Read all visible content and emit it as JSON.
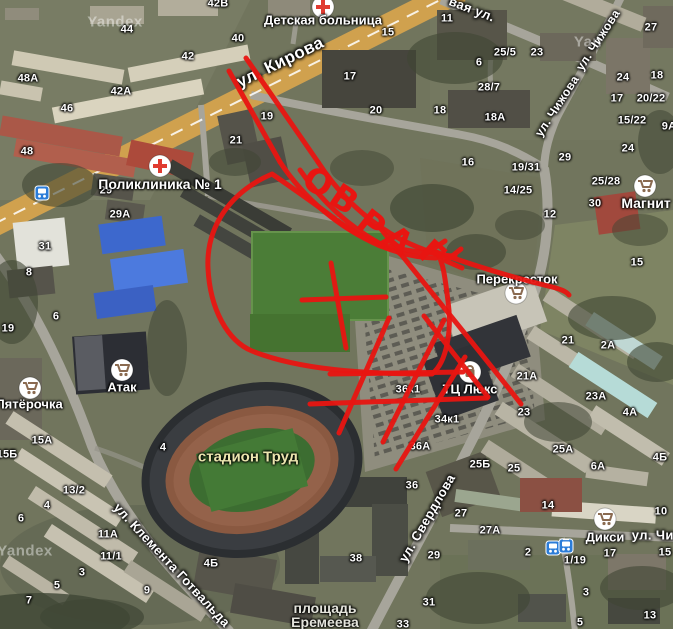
{
  "map": {
    "provider_watermark": "Yandex"
  },
  "watermarks": [
    {
      "text": "Yandex",
      "x": 115,
      "y": 22
    },
    {
      "text": "Yan",
      "x": 588,
      "y": 42
    },
    {
      "text": "Yandex",
      "x": 25,
      "y": 551
    }
  ],
  "streets": [
    {
      "name": "ул. Кирова",
      "x": 280,
      "y": 62,
      "rot": -26,
      "size": 17
    },
    {
      "name": "вая ул.",
      "x": 472,
      "y": 9,
      "rot": 21,
      "size": 13
    },
    {
      "name": "ул. Чижова",
      "x": 598,
      "y": 40,
      "rot": -57,
      "size": 12
    },
    {
      "name": "ул. Чижова",
      "x": 557,
      "y": 106,
      "rot": -57,
      "size": 12
    },
    {
      "name": "ул. Свердлова",
      "x": 427,
      "y": 518,
      "rot": -60,
      "size": 13
    },
    {
      "name": "ул. Клемента Готвальда",
      "x": 172,
      "y": 565,
      "rot": 47,
      "size": 13
    },
    {
      "name": "ул. Чистова",
      "x": 672,
      "y": 535,
      "rot": 0,
      "size": 13
    }
  ],
  "poi": [
    {
      "name": "Детская больница",
      "tx": 323,
      "ty": 20,
      "ix": 323,
      "iy": 7,
      "icon": "cross",
      "size": 13
    },
    {
      "name": "Поликлиника № 1",
      "tx": 160,
      "ty": 184,
      "ix": 160,
      "iy": 166,
      "icon": "cross",
      "size": 14
    },
    {
      "name": "Магнит",
      "tx": 646,
      "ty": 203,
      "ix": 645,
      "iy": 186,
      "icon": "cart",
      "size": 14
    },
    {
      "name": "Перекресток",
      "tx": 517,
      "ty": 279,
      "ix": 516,
      "iy": 293,
      "icon": "cart",
      "size": 13
    },
    {
      "name": "Атак",
      "tx": 122,
      "ty": 387,
      "ix": 122,
      "iy": 370,
      "icon": "cart",
      "size": 13
    },
    {
      "name": "Пятёрочка",
      "tx": 29,
      "ty": 404,
      "ix": 30,
      "iy": 388,
      "icon": "cart",
      "size": 13
    },
    {
      "name": "ТЦ Люкс",
      "tx": 470,
      "ty": 389,
      "ix": 470,
      "iy": 372,
      "icon": "bag",
      "size": 13
    },
    {
      "name": "Дикси",
      "tx": 605,
      "ty": 537,
      "ix": 605,
      "iy": 519,
      "icon": "cart",
      "size": 13
    }
  ],
  "area_labels": [
    {
      "lines": [
        "стадион Труд"
      ],
      "x": 248,
      "y": 457,
      "color": "#ebe5ae",
      "size": 15
    },
    {
      "lines": [
        "площадь",
        "Еремеева"
      ],
      "x": 325,
      "y": 615,
      "color": "#e4e4dc",
      "size": 14
    }
  ],
  "transit_stops": [
    {
      "x": 42,
      "y": 193,
      "type": "bus"
    },
    {
      "x": 553,
      "y": 548,
      "type": "bus"
    },
    {
      "x": 566,
      "y": 546,
      "type": "tram"
    }
  ],
  "building_numbers": [
    {
      "t": "44",
      "x": 127,
      "y": 30
    },
    {
      "t": "42В",
      "x": 218,
      "y": 4
    },
    {
      "t": "42",
      "x": 188,
      "y": 57
    },
    {
      "t": "48А",
      "x": 28,
      "y": 79
    },
    {
      "t": "42А",
      "x": 121,
      "y": 92
    },
    {
      "t": "46",
      "x": 67,
      "y": 109
    },
    {
      "t": "48",
      "x": 27,
      "y": 152
    },
    {
      "t": "40",
      "x": 238,
      "y": 39
    },
    {
      "t": "15",
      "x": 388,
      "y": 33
    },
    {
      "t": "17",
      "x": 350,
      "y": 77
    },
    {
      "t": "20",
      "x": 376,
      "y": 111
    },
    {
      "t": "18",
      "x": 440,
      "y": 111
    },
    {
      "t": "19",
      "x": 267,
      "y": 117
    },
    {
      "t": "21",
      "x": 236,
      "y": 141
    },
    {
      "t": "11",
      "x": 447,
      "y": 19
    },
    {
      "t": "25/5",
      "x": 505,
      "y": 53
    },
    {
      "t": "23",
      "x": 537,
      "y": 53
    },
    {
      "t": "27",
      "x": 651,
      "y": 28
    },
    {
      "t": "6",
      "x": 479,
      "y": 63
    },
    {
      "t": "28/7",
      "x": 489,
      "y": 88
    },
    {
      "t": "18А",
      "x": 495,
      "y": 118
    },
    {
      "t": "24",
      "x": 623,
      "y": 78
    },
    {
      "t": "18",
      "x": 657,
      "y": 76
    },
    {
      "t": "17",
      "x": 617,
      "y": 99
    },
    {
      "t": "20/22",
      "x": 651,
      "y": 99
    },
    {
      "t": "15/22",
      "x": 632,
      "y": 121
    },
    {
      "t": "9А",
      "x": 669,
      "y": 127
    },
    {
      "t": "16",
      "x": 468,
      "y": 163
    },
    {
      "t": "29",
      "x": 565,
      "y": 158
    },
    {
      "t": "19/31",
      "x": 526,
      "y": 168
    },
    {
      "t": "25/28",
      "x": 606,
      "y": 182
    },
    {
      "t": "14/25",
      "x": 518,
      "y": 191
    },
    {
      "t": "30",
      "x": 595,
      "y": 204
    },
    {
      "t": "24",
      "x": 628,
      "y": 149
    },
    {
      "t": "12",
      "x": 550,
      "y": 215
    },
    {
      "t": "15",
      "x": 637,
      "y": 263
    },
    {
      "t": "29",
      "x": 106,
      "y": 191
    },
    {
      "t": "29А",
      "x": 120,
      "y": 215
    },
    {
      "t": "31",
      "x": 45,
      "y": 247
    },
    {
      "t": "8",
      "x": 29,
      "y": 273
    },
    {
      "t": "19",
      "x": 8,
      "y": 329
    },
    {
      "t": "6",
      "x": 56,
      "y": 317
    },
    {
      "t": "15А",
      "x": 42,
      "y": 441
    },
    {
      "t": "15Б",
      "x": 7,
      "y": 455
    },
    {
      "t": "4",
      "x": 163,
      "y": 448
    },
    {
      "t": "36к1",
      "x": 408,
      "y": 390
    },
    {
      "t": "34к1",
      "x": 447,
      "y": 420
    },
    {
      "t": "36А",
      "x": 420,
      "y": 447
    },
    {
      "t": "36",
      "x": 412,
      "y": 486
    },
    {
      "t": "38",
      "x": 356,
      "y": 559
    },
    {
      "t": "21",
      "x": 568,
      "y": 341
    },
    {
      "t": "2А",
      "x": 608,
      "y": 346
    },
    {
      "t": "21А",
      "x": 527,
      "y": 377
    },
    {
      "t": "23",
      "x": 524,
      "y": 413
    },
    {
      "t": "23А",
      "x": 596,
      "y": 397
    },
    {
      "t": "4А",
      "x": 630,
      "y": 413
    },
    {
      "t": "25А",
      "x": 563,
      "y": 450
    },
    {
      "t": "25Б",
      "x": 480,
      "y": 465
    },
    {
      "t": "25",
      "x": 514,
      "y": 469
    },
    {
      "t": "6А",
      "x": 598,
      "y": 467
    },
    {
      "t": "4Б",
      "x": 660,
      "y": 458
    },
    {
      "t": "27",
      "x": 461,
      "y": 514
    },
    {
      "t": "27А",
      "x": 490,
      "y": 531
    },
    {
      "t": "14",
      "x": 548,
      "y": 506
    },
    {
      "t": "10",
      "x": 661,
      "y": 512
    },
    {
      "t": "2",
      "x": 528,
      "y": 553
    },
    {
      "t": "17",
      "x": 610,
      "y": 554
    },
    {
      "t": "15",
      "x": 665,
      "y": 553
    },
    {
      "t": "1/19",
      "x": 575,
      "y": 561
    },
    {
      "t": "3",
      "x": 586,
      "y": 593
    },
    {
      "t": "13",
      "x": 650,
      "y": 616
    },
    {
      "t": "5",
      "x": 580,
      "y": 623
    },
    {
      "t": "29",
      "x": 434,
      "y": 556
    },
    {
      "t": "31",
      "x": 429,
      "y": 603
    },
    {
      "t": "33",
      "x": 403,
      "y": 625
    },
    {
      "t": "13/2",
      "x": 74,
      "y": 491
    },
    {
      "t": "4",
      "x": 47,
      "y": 506
    },
    {
      "t": "6",
      "x": 21,
      "y": 519
    },
    {
      "t": "11А",
      "x": 108,
      "y": 535
    },
    {
      "t": "11/1",
      "x": 111,
      "y": 557
    },
    {
      "t": "3",
      "x": 82,
      "y": 573
    },
    {
      "t": "5",
      "x": 57,
      "y": 586
    },
    {
      "t": "7",
      "x": 29,
      "y": 601
    },
    {
      "t": "9",
      "x": 147,
      "y": 591
    },
    {
      "t": "4Б",
      "x": 211,
      "y": 564
    }
  ],
  "annotation": {
    "color": "#e81511",
    "word": "ОВРАГ",
    "letters": [
      {
        "ch": "О",
        "x": 317,
        "y": 184,
        "rot": 30
      },
      {
        "ch": "В",
        "x": 343,
        "y": 201,
        "rot": 34
      },
      {
        "ch": "Р",
        "x": 370,
        "y": 226,
        "rot": 38
      },
      {
        "ch": "А",
        "x": 397,
        "y": 242,
        "rot": 40
      },
      {
        "ch": "Г",
        "x": 430,
        "y": 255,
        "rot": 42
      }
    ],
    "strokes": [
      "M229,71 L280,162",
      "M246,58 L318,162",
      "M280,162 C305,200 340,228 378,245 C400,254 420,258 436,258",
      "M318,162 C340,196 368,222 402,240 C422,250 440,256 455,256",
      "M300,170 C322,202 352,230 390,249",
      "M436,252 C475,266 515,278 552,287 C560,289 566,291 569,295",
      "M445,241 L430,251 L446,259",
      "M461,249 L446,261 L462,268",
      "M272,174 C230,192 206,227 208,268 C210,310 228,341 252,351 C300,370 365,374 432,374 C447,362 452,330 448,301 C445,277 443,261 437,253 C398,252 366,242 338,221 C315,204 291,187 272,174 Z",
      "M302,300 L386,297",
      "M331,263 L346,348",
      "M330,374 L463,372",
      "M310,404 L487,398",
      "M339,433 L389,318",
      "M383,442 L444,320",
      "M396,469 L465,357",
      "M424,316 L488,397",
      "M381,229 C425,285 475,345 521,404"
    ]
  }
}
